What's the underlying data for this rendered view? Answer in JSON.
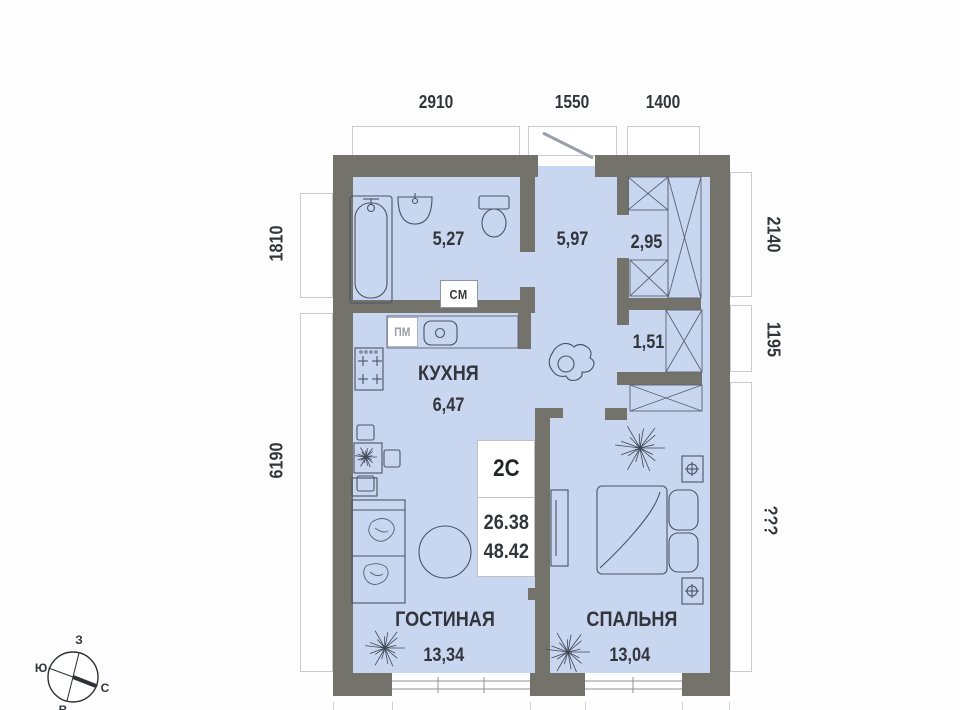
{
  "plan": {
    "unit": {
      "badge": "2С",
      "living_area": "26.38",
      "total_area": "48.42"
    },
    "rooms": {
      "bathroom": {
        "area": "5,27"
      },
      "hall": {
        "area": "5,97"
      },
      "closet": {
        "area": "2,95"
      },
      "niche": {
        "area": "1,51"
      },
      "kitchen": {
        "name": "КУХНЯ",
        "area": "6,47"
      },
      "living": {
        "name": "ГОСТИНАЯ",
        "area": "13,34"
      },
      "bedroom": {
        "name": "СПАЛЬНЯ",
        "area": "13,04"
      }
    },
    "appliances": {
      "washing_machine": "СМ",
      "dishwasher": "ПМ"
    },
    "dimensions": {
      "top": [
        "2910",
        "1550",
        "1400"
      ],
      "left": [
        "1810",
        "6190"
      ],
      "right": [
        "2140",
        "1195",
        "???"
      ]
    },
    "compass": {
      "west": "З",
      "south": "Ю",
      "north": "С",
      "east": "В"
    },
    "colors": {
      "wall": "#73736b",
      "floor": "#c9d6f0",
      "outline": "#4a5366"
    }
  }
}
